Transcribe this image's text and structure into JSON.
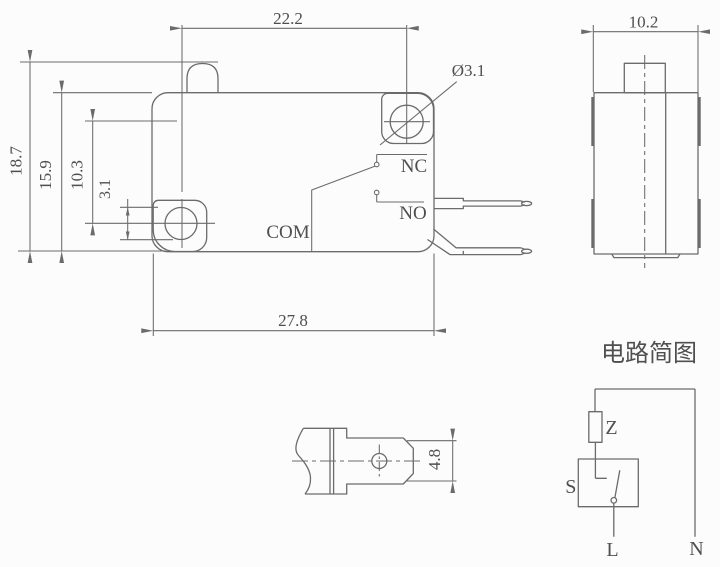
{
  "colors": {
    "line": "#6b6b6b",
    "text": "#4f4f4f",
    "background": "#fcfcfc"
  },
  "front_view": {
    "dim_button_to_hole": "22.2",
    "dim_overall_height": "18.7",
    "dim_body_height": "15.9",
    "dim_hole_center_spacing": "10.3",
    "dim_hole_small": "3.1",
    "dim_hole_diameter": "Ø3.1",
    "dim_body_width": "27.8",
    "label_nc": "NC",
    "label_no": "NO",
    "label_com": "COM"
  },
  "side_view": {
    "dim_body_depth": "10.2"
  },
  "terminal_detail": {
    "dim_terminal_width": "4.8"
  },
  "circuit_diagram": {
    "title": "电路简图",
    "label_z": "Z",
    "label_s": "S",
    "label_l": "L",
    "label_n": "N"
  }
}
